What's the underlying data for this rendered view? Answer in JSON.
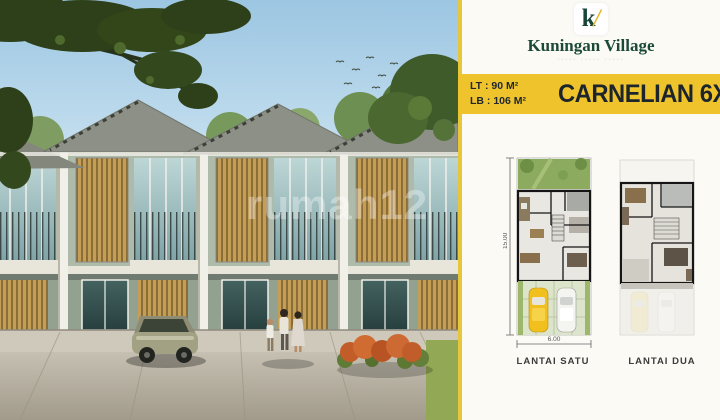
{
  "brand": {
    "mark_letter": "k",
    "mark_slash": "/",
    "name": "Kuningan Village",
    "tagline": "····· ····· ·····"
  },
  "badge": {
    "lt": "LT : 90 M²",
    "lb": "LB : 106 M²",
    "title": "CARNELIAN 6X1"
  },
  "floorplans": {
    "plan1": {
      "label": "LANTAI SATU",
      "depth_dim": "15.00",
      "width_dim": "6.00"
    },
    "plan2": {
      "label": "LANTAI DUA"
    }
  },
  "photo": {
    "watermark": "rumah12"
  },
  "colors": {
    "accent_yellow": "#eec32c",
    "brand_green": "#1c4a39",
    "badge_text": "#1e262e",
    "panel_bg": "#fbfaf5"
  }
}
